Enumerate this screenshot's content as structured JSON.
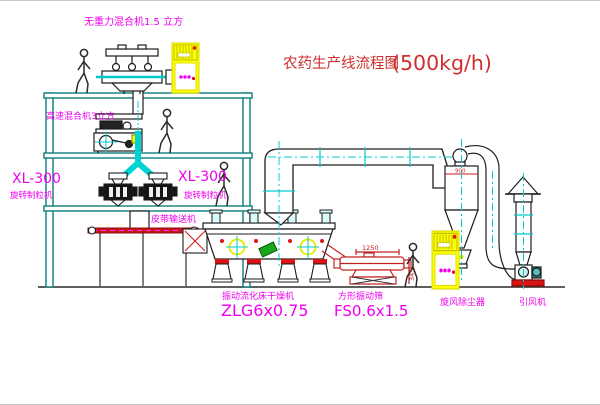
{
  "drawing": {
    "title": {
      "name_cn": "农药生产线流程图",
      "capacity": "(500kg/h)"
    },
    "equipment": {
      "mixer_top": {
        "label": "无重力混合机1.5 立方"
      },
      "mixer_mid": {
        "label": "高速混合机3立方"
      },
      "granulator_left": {
        "model": "XL-300",
        "name": "旋转制粒机"
      },
      "granulator_right": {
        "model": "XL-300",
        "name": "旋转制粒机"
      },
      "belt_conveyor": {
        "name": "皮带输送机"
      },
      "dryer": {
        "name": "振动流化床干燥机",
        "model": "ZLG6x0.75"
      },
      "screen": {
        "name": "方形振动筛",
        "model": "FS0.6x1.5",
        "dim_length": "1250",
        "dim_height": "345"
      },
      "cyclone": {
        "name": "旋风除尘器",
        "dim": "900"
      },
      "fan": {
        "name": "引风机"
      }
    },
    "colors": {
      "structure_teal": "#0b7d7d",
      "accent_cyan": "#00cccc",
      "label_magenta": "#ee00ee",
      "title_red": "#cf2f2f",
      "machine_dark": "#1d1d1d",
      "alert_red": "#d81414",
      "cabinet_yellow": "#ffff00",
      "dryer_green": "#19a819"
    }
  }
}
